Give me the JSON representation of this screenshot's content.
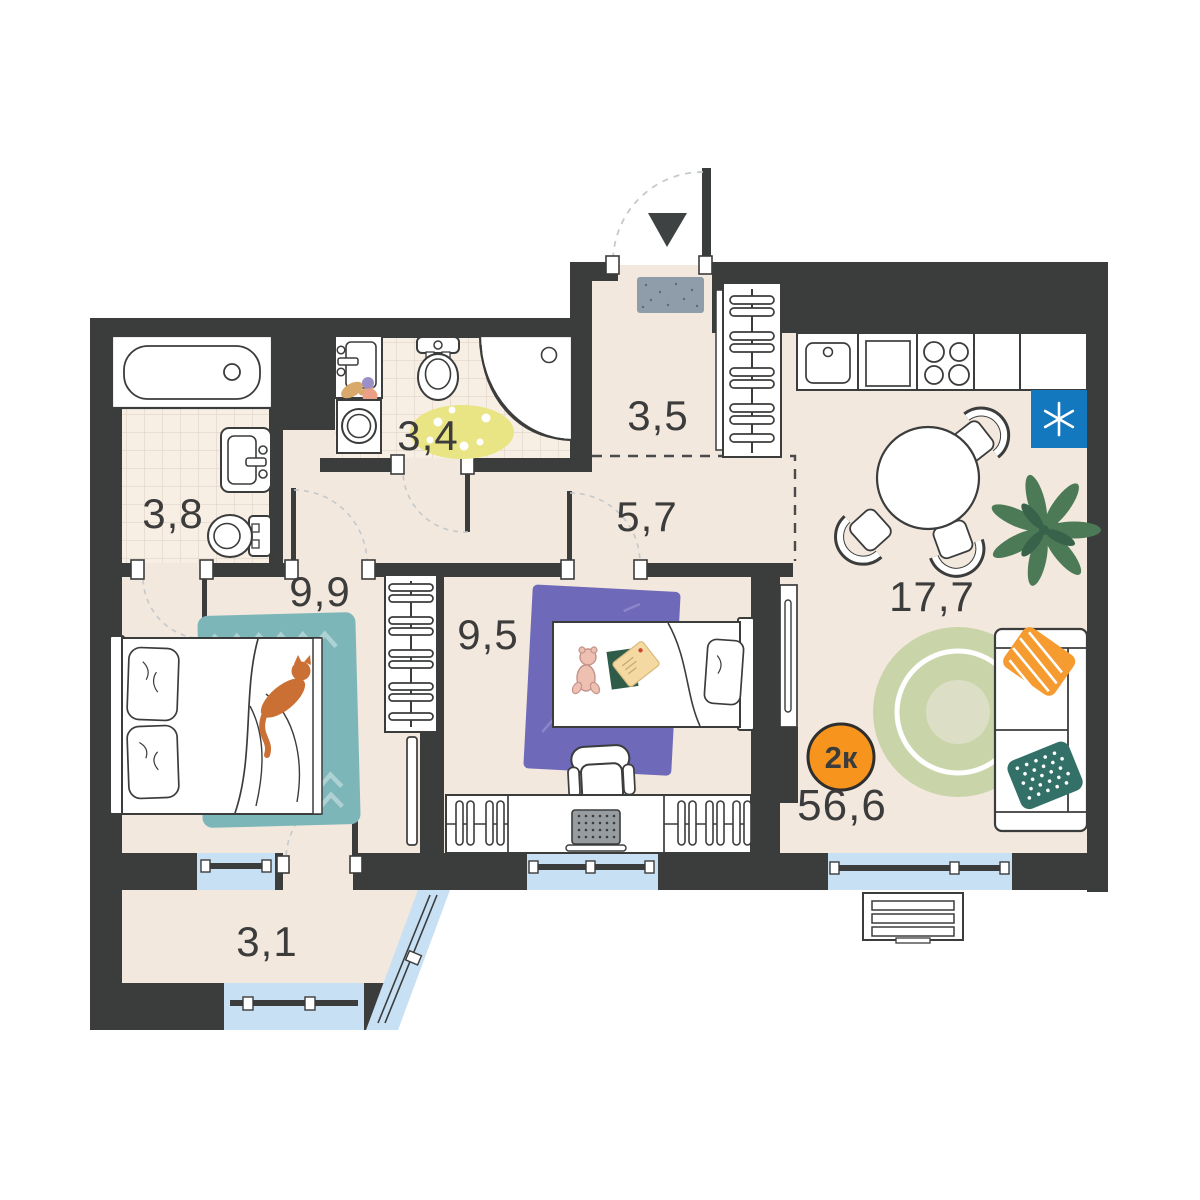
{
  "plan": {
    "type_badge": {
      "label": "2к",
      "color": "#f7941e"
    },
    "total_area": "56,6",
    "rooms": [
      {
        "name": "ensuite-bathroom",
        "area": "3,8"
      },
      {
        "name": "bathroom",
        "area": "3,4"
      },
      {
        "name": "entry-hall",
        "area": "3,5"
      },
      {
        "name": "corridor",
        "area": "5,7"
      },
      {
        "name": "bedroom",
        "area": "9,9"
      },
      {
        "name": "kids-room",
        "area": "9,5"
      },
      {
        "name": "kitchen-living-room",
        "area": "17,7"
      },
      {
        "name": "balcony",
        "area": "3,1"
      }
    ],
    "icons": {
      "entrance_arrow": "▼",
      "fridge_asterisk": "✳"
    },
    "colors": {
      "wall": "#3b3c3c",
      "floor": "#f2e8dd",
      "tile": "#f8efe4",
      "tile_grid": "#e0d4c6",
      "window": "#c8e0f4",
      "badge": "#f7941e",
      "fridge": "#1478be",
      "rug_bedroom": "#7db6b8",
      "rug_kids": "#6e69b8",
      "rug_bath": "#e9e484",
      "rug_living": "#c9d5a9",
      "pillow_orange": "#f59b2f",
      "pillow_teal": "#337068",
      "plant": "#4c7a57",
      "cat": "#cb7034",
      "doormat": "#8f9dab"
    }
  }
}
